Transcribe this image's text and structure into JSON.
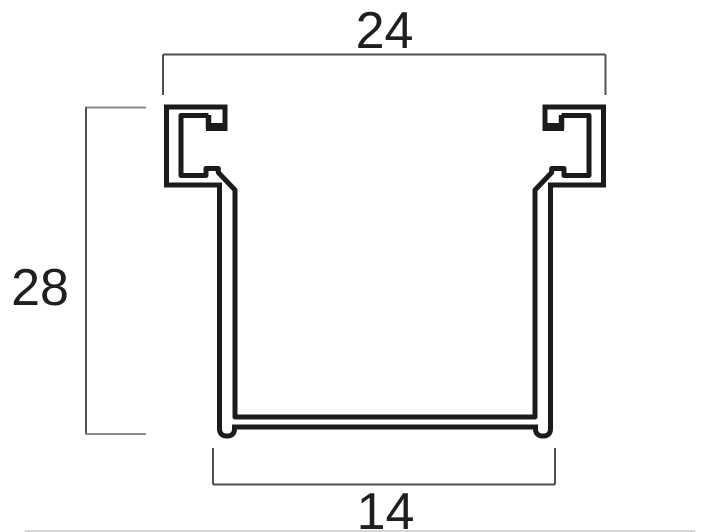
{
  "diagram": {
    "title": "channel-profile-cross-section",
    "description": "2D technical drawing of an extruded C-channel rail cross-section with hooked top flanges, footed base, and three linear dimensions",
    "background_color": "#ffffff",
    "profile_line_color": "#1b1b1b",
    "dimension_line_color": "#4f4f4f",
    "text_color": "#1f1f1f",
    "dimensions": {
      "top": {
        "label": "24",
        "value": 24,
        "orientation": "horizontal",
        "position": "top",
        "measures": "overall outer width across both top hooks"
      },
      "left": {
        "label": "28",
        "value": 28,
        "orientation": "vertical",
        "position": "left",
        "measures": "overall height from top of hooks to bottom of feet"
      },
      "bottom": {
        "label": "14",
        "value": 14,
        "orientation": "horizontal",
        "position": "bottom",
        "measures": "outer width across the base feet"
      }
    },
    "features": [
      "left top hook with inward lip and notch",
      "right top hook (mirror image)",
      "inner stub rib on each hook bottom",
      "diagonal transition into side walls",
      "double-line wall thickness rendering",
      "channel floor with protruding rounded feet"
    ]
  }
}
